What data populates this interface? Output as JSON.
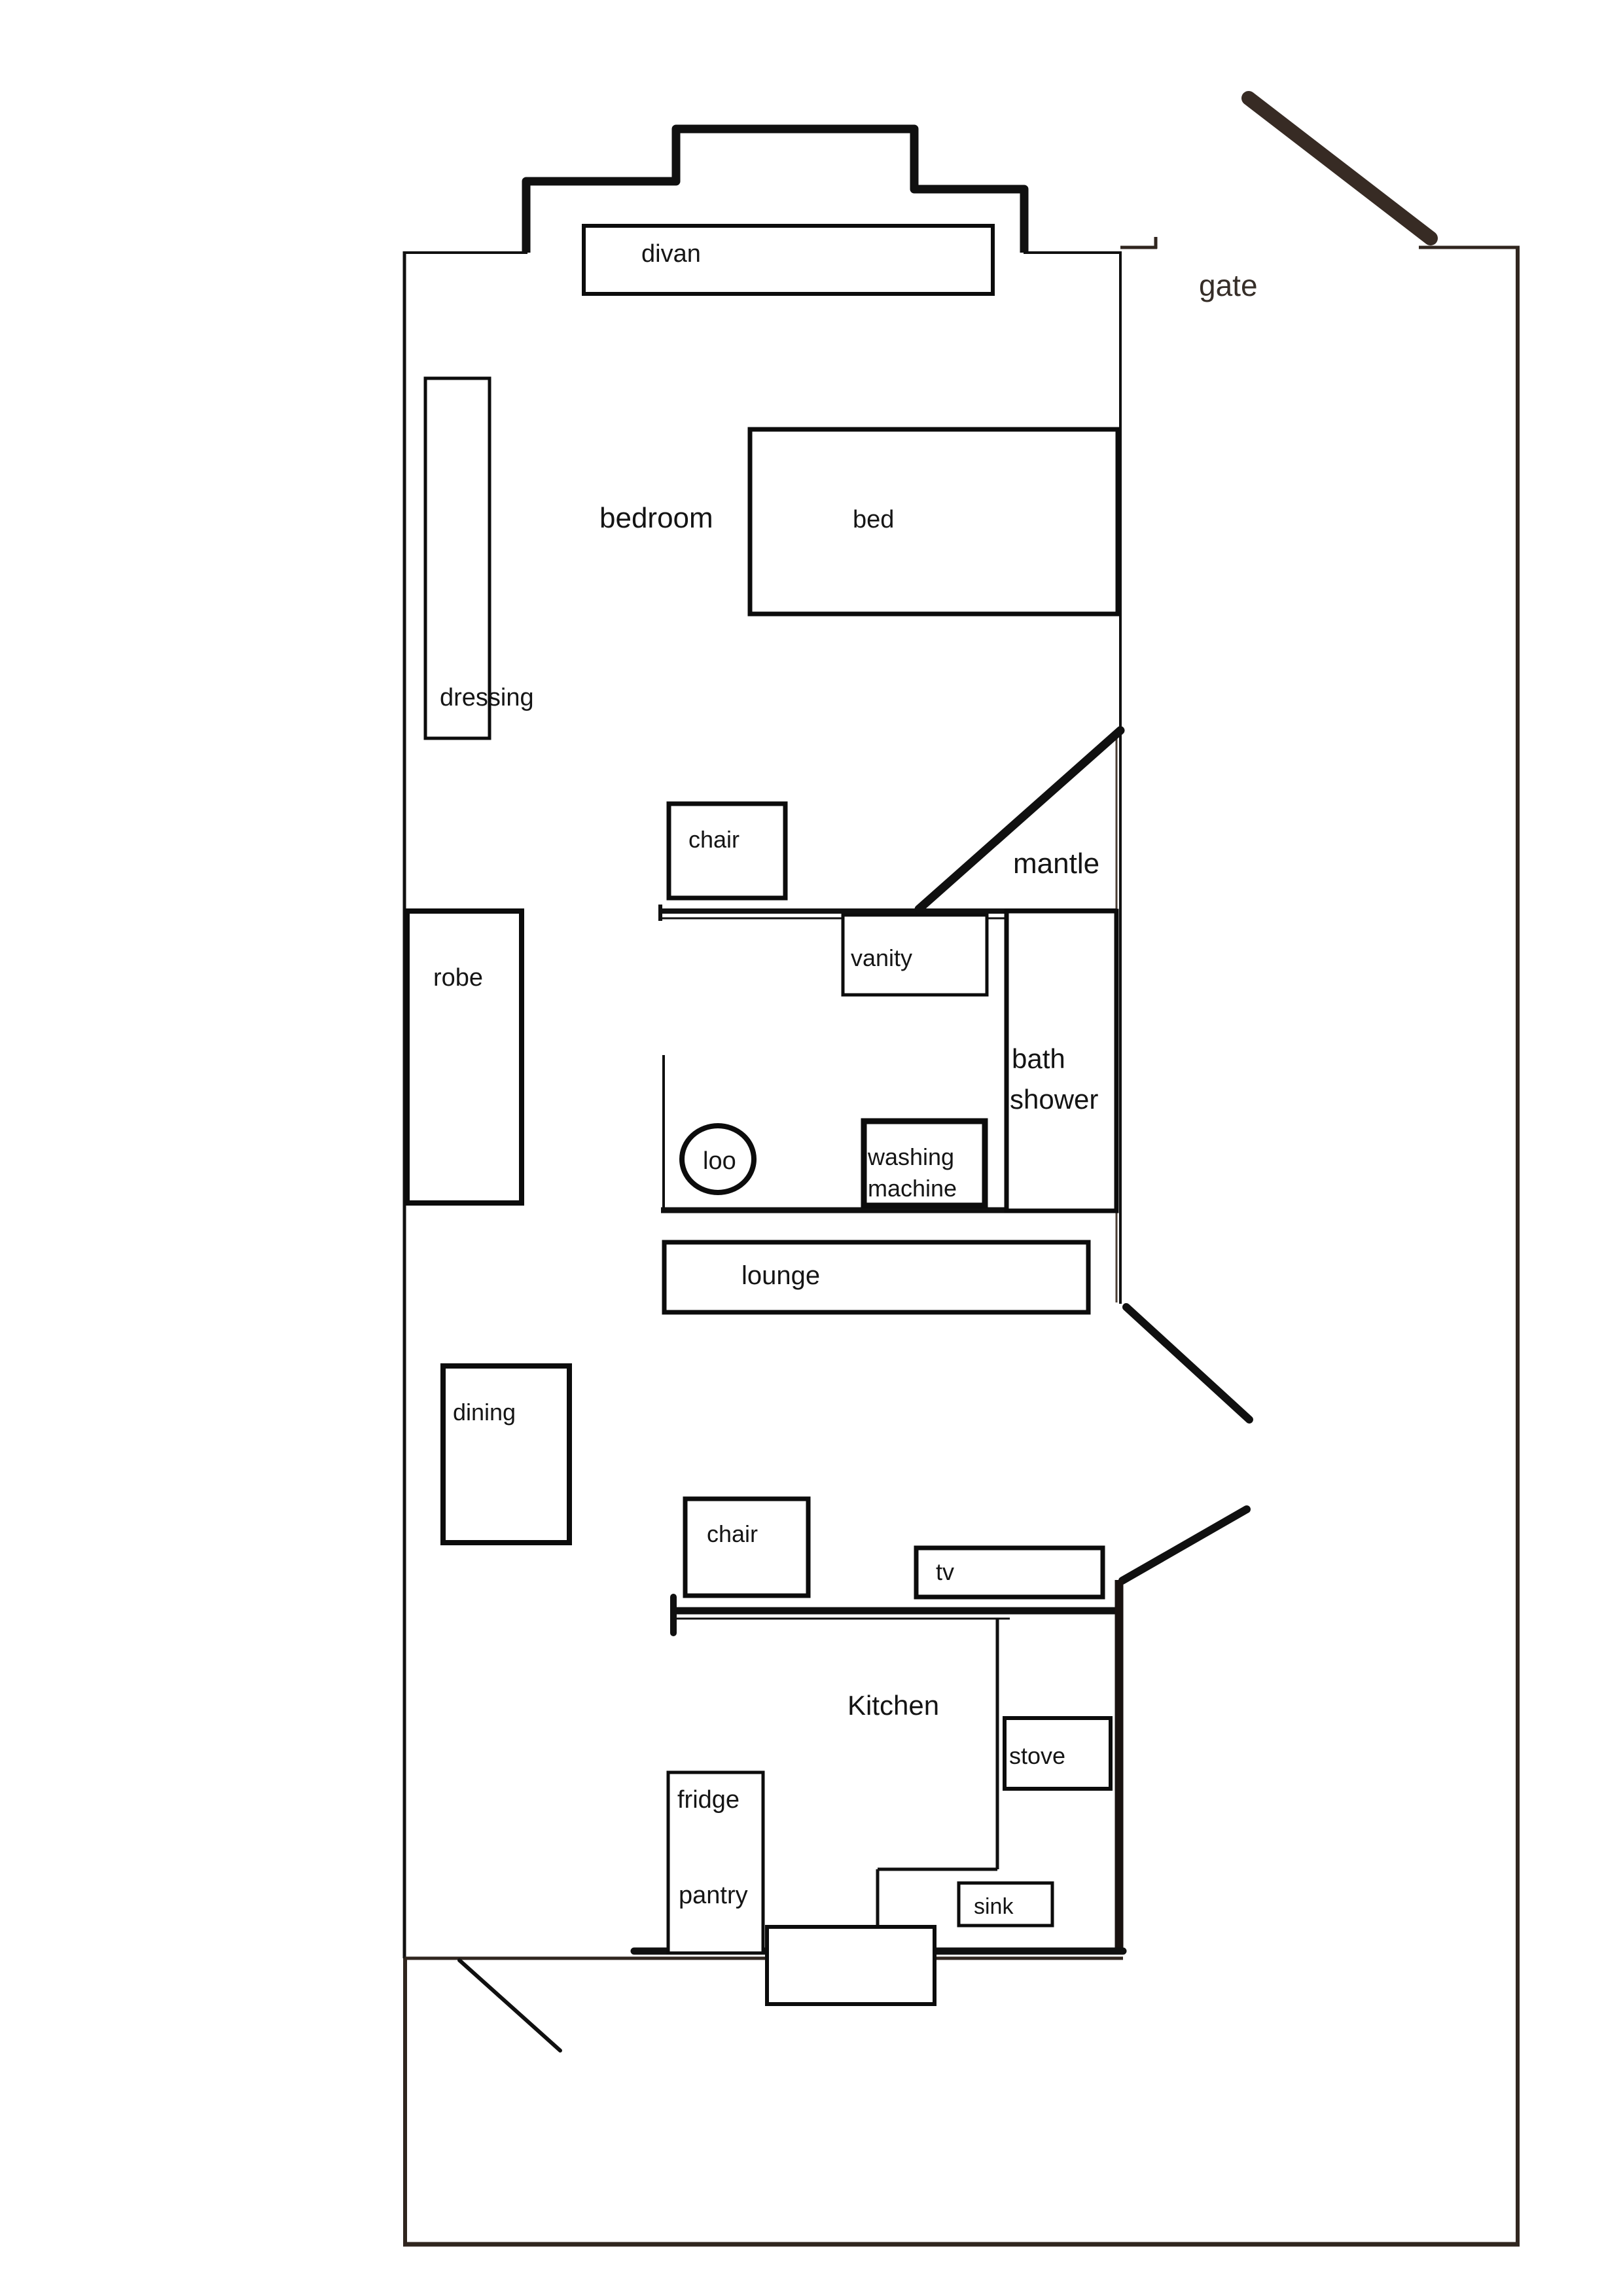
{
  "title": "house floor plan sketch",
  "labels": {
    "divan": "divan",
    "gate": "gate",
    "bedroom": "bedroom",
    "bed": "bed",
    "dressing": "dressing",
    "chair_bedroom": "chair",
    "mantle": "mantle",
    "vanity": "vanity",
    "robe": "robe",
    "bath": "bath",
    "shower": "shower",
    "loo": "loo",
    "washing_line1": "washing",
    "washing_line2": "machine",
    "lounge": "lounge",
    "dining": "dining",
    "chair_living": "chair",
    "tv": "tv",
    "kitchen": "Kitchen",
    "stove": "stove",
    "fridge": "fridge",
    "pantry": "pantry",
    "sink": "sink"
  },
  "colors": {
    "wall_ink": "#101010",
    "furniture_ink": "#0c0c0c",
    "boundary_brown": "#30261f",
    "gate_brown": "#372b24",
    "text_ink": "#151515",
    "paper": "#ffffff"
  }
}
